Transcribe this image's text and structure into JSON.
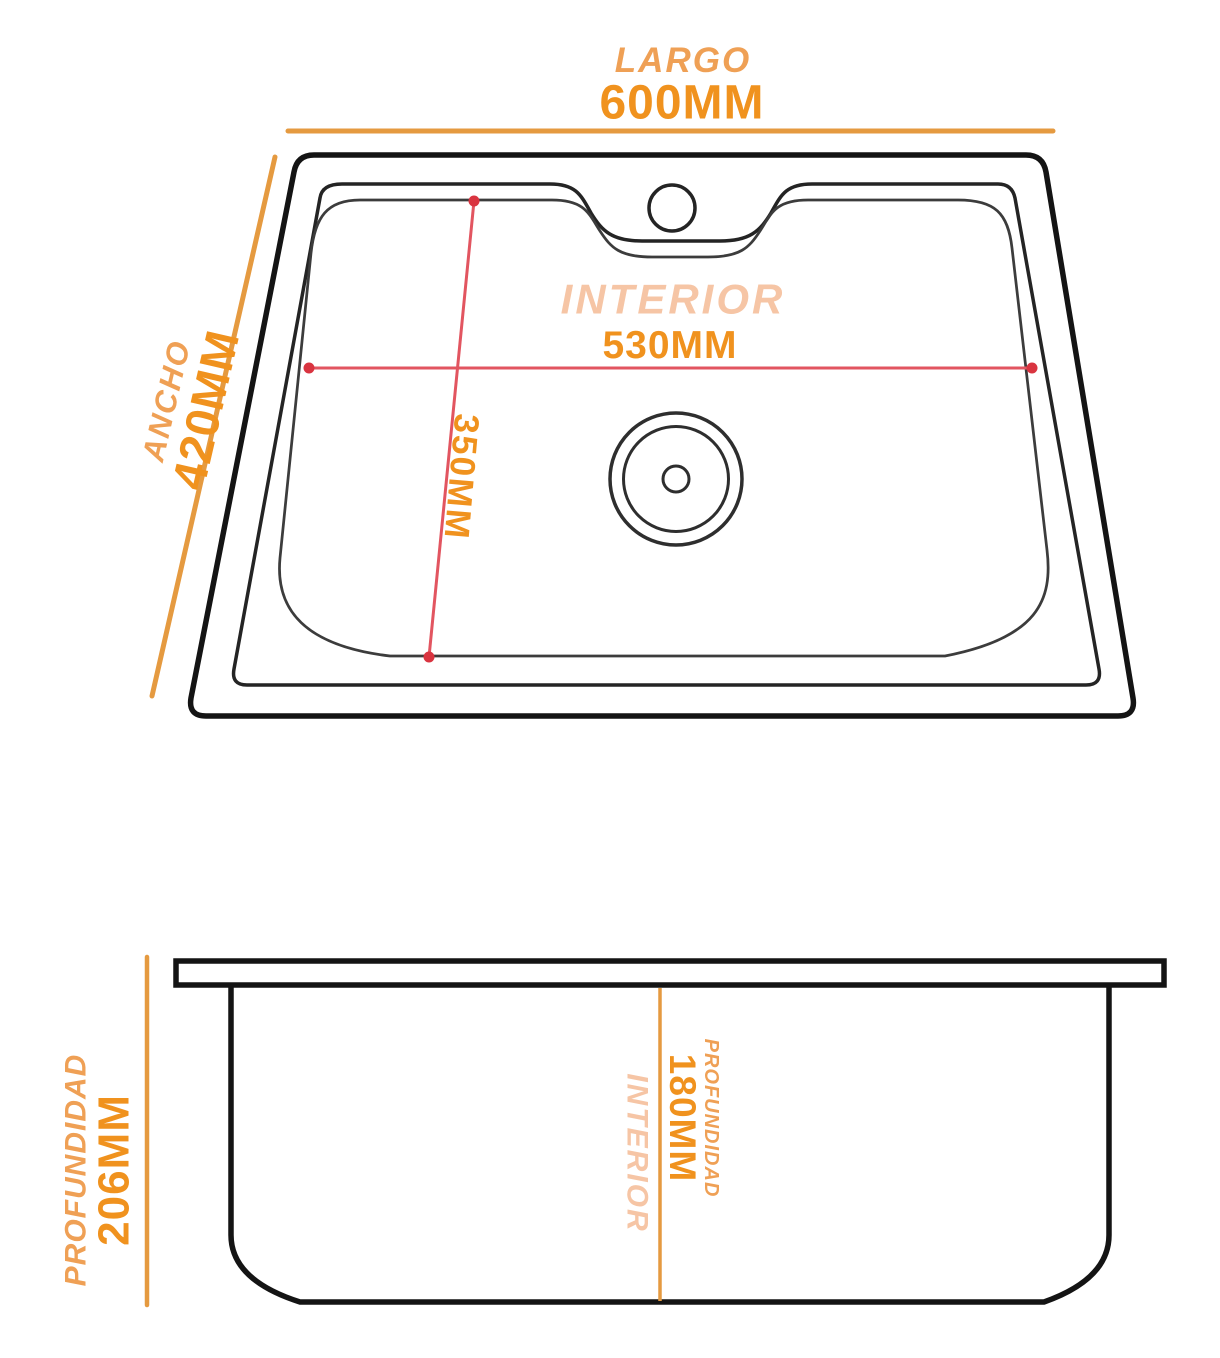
{
  "colors": {
    "label_orange": "#EFA055",
    "value_orange": "#F0921E",
    "peach": "#F6C5A5",
    "dimension_line_orange": "#E59A40",
    "red_line": "#E25560",
    "red_dot": "#D93440",
    "outline_black": "#141414",
    "background": "#FFFFFF"
  },
  "top_view": {
    "largo": {
      "label": "LARGO",
      "value": "600MM"
    },
    "ancho": {
      "label": "ANCHO",
      "value": "420MM"
    },
    "interior": {
      "label": "INTERIOR",
      "value": "530MM"
    },
    "interior_height": {
      "value": "350MM"
    }
  },
  "side_view": {
    "profundidad": {
      "label": "PROFUNDIDAD",
      "value": "206MM"
    },
    "interior": {
      "label": "INTERIOR"
    },
    "profundidad_interior": {
      "label": "PROFUNDIDAD",
      "value": "180MM"
    }
  }
}
